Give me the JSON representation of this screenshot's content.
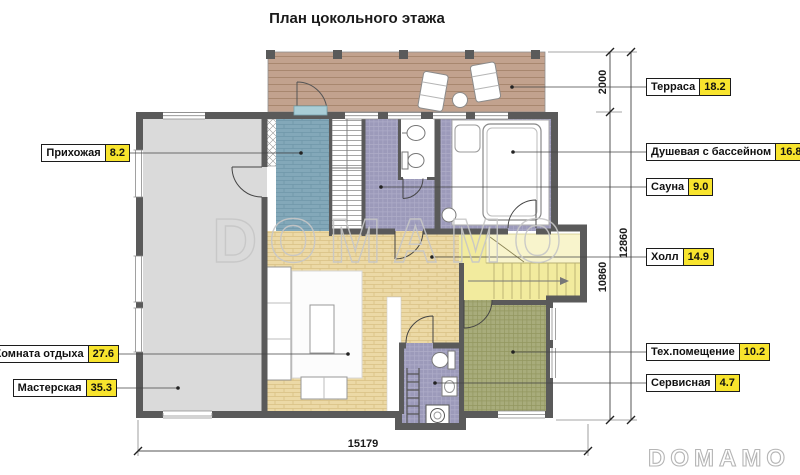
{
  "title": "План цокольного этажа",
  "watermark_text": "DOMAMO",
  "logo_text": "DOMAMO",
  "rooms": {
    "terrace": {
      "name": "Терраса",
      "area": "18.2"
    },
    "hallway": {
      "name": "Прихожая",
      "area": "8.2"
    },
    "shower_pool": {
      "name": "Душевая с бассейном",
      "area": "16.8"
    },
    "sauna": {
      "name": "Сауна",
      "area": "9.0"
    },
    "hall": {
      "name": "Холл",
      "area": "14.9"
    },
    "lounge": {
      "name": "Комната отдыха",
      "area": "27.6"
    },
    "workshop": {
      "name": "Мастерская",
      "area": "35.3"
    },
    "tech": {
      "name": "Тех.помещение",
      "area": "10.2"
    },
    "service": {
      "name": "Сервисная",
      "area": "4.7"
    }
  },
  "dimensions": {
    "terrace_depth": "2000",
    "house_depth": "10860",
    "total_depth": "12860",
    "total_width": "15179"
  },
  "colors": {
    "wall": "#5a5a5a",
    "workshop_floor": "#dadada",
    "hallway_tile": "#83a8b9",
    "wet_tile": "#9c9aba",
    "hall_tile": "#ecd9a6",
    "tech_tile": "#a8ac7b",
    "terrace_deck": "#c2a28e",
    "stairs_fill": "#f2eb9e",
    "label_value_bg": "#f8e42d"
  }
}
